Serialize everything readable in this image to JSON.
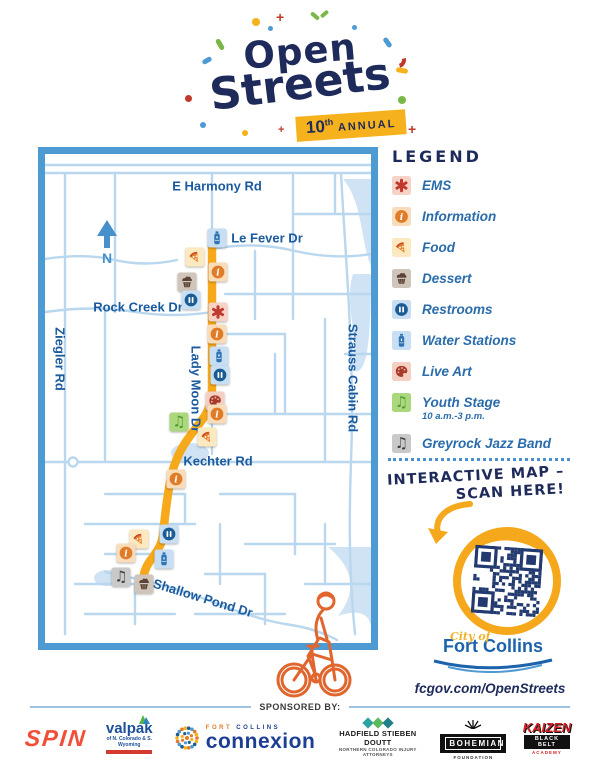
{
  "header": {
    "title_line1": "Open",
    "title_line2": "Streets",
    "badge": {
      "number": "10",
      "suffix": "th",
      "word": "ANNUAL"
    }
  },
  "map": {
    "north_label": "N",
    "street_labels": [
      {
        "text": "E Harmony Rd",
        "x": 172,
        "y": 32,
        "style": "h"
      },
      {
        "text": "Le Fever Dr",
        "x": 222,
        "y": 84,
        "style": "h"
      },
      {
        "text": "Rock Creek Dr",
        "x": 93,
        "y": 153,
        "style": "h"
      },
      {
        "text": "Ziegler Rd",
        "x": 15,
        "y": 205,
        "style": "v"
      },
      {
        "text": "Lady Moon Dr",
        "x": 151,
        "y": 235,
        "style": "v"
      },
      {
        "text": "Strauss Cabin Rd",
        "x": 308,
        "y": 224,
        "style": "v"
      },
      {
        "text": "Kechter Rd",
        "x": 173,
        "y": 307,
        "style": "h"
      },
      {
        "text": "Shallow Pond Dr",
        "x": 158,
        "y": 444,
        "style": "tilt"
      }
    ],
    "markers": [
      {
        "type": "water",
        "x": 172,
        "y": 84
      },
      {
        "type": "food",
        "x": 150,
        "y": 103
      },
      {
        "type": "info",
        "x": 173,
        "y": 118
      },
      {
        "type": "dessert",
        "x": 142,
        "y": 128
      },
      {
        "type": "restrooms",
        "x": 146,
        "y": 146
      },
      {
        "type": "ems",
        "x": 173,
        "y": 158
      },
      {
        "type": "info",
        "x": 172,
        "y": 180
      },
      {
        "type": "water",
        "x": 174,
        "y": 202
      },
      {
        "type": "restrooms",
        "x": 175,
        "y": 221
      },
      {
        "type": "liveart",
        "x": 170,
        "y": 247
      },
      {
        "type": "info",
        "x": 172,
        "y": 260
      },
      {
        "type": "youth",
        "x": 134,
        "y": 268
      },
      {
        "type": "food",
        "x": 162,
        "y": 283
      },
      {
        "type": "info",
        "x": 131,
        "y": 325
      },
      {
        "type": "restrooms",
        "x": 124,
        "y": 380
      },
      {
        "type": "food",
        "x": 94,
        "y": 385
      },
      {
        "type": "info",
        "x": 81,
        "y": 399
      },
      {
        "type": "water",
        "x": 119,
        "y": 405
      },
      {
        "type": "jazz",
        "x": 76,
        "y": 423
      },
      {
        "type": "dessert",
        "x": 99,
        "y": 430
      }
    ]
  },
  "legend": {
    "title": "LEGEND",
    "items": [
      {
        "type": "ems",
        "icon": "ems-icon",
        "label": "EMS"
      },
      {
        "type": "info",
        "icon": "information-icon",
        "label": "Information"
      },
      {
        "type": "food",
        "icon": "food-icon",
        "label": "Food"
      },
      {
        "type": "dessert",
        "icon": "dessert-icon",
        "label": "Dessert"
      },
      {
        "type": "restrooms",
        "icon": "restrooms-icon",
        "label": "Restrooms"
      },
      {
        "type": "water",
        "icon": "water-station-icon",
        "label": "Water Stations"
      },
      {
        "type": "liveart",
        "icon": "live-art-icon",
        "label": "Live Art"
      },
      {
        "type": "youth",
        "icon": "youth-stage-icon",
        "label": "Youth Stage",
        "sub": "10 a.m.-3 p.m."
      },
      {
        "type": "jazz",
        "icon": "jazz-band-icon",
        "label": "Greyrock Jazz Band"
      }
    ]
  },
  "cta": {
    "line1": "INTERACTIVE MAP –",
    "line2": "SCAN HERE!"
  },
  "footer": {
    "city_of": "City of",
    "city_name": "Fort Collins",
    "url": "fcgov.com/OpenStreets",
    "sponsored_by": "SPONSORED BY:",
    "sponsors": [
      {
        "id": "spin",
        "display": "SPIN"
      },
      {
        "id": "valpak",
        "display": "valpak",
        "sub": "of N. Colorado & S. Wyoming"
      },
      {
        "id": "connexion",
        "top1": "FORT",
        "top2": "COLLINS",
        "display": "connexion"
      },
      {
        "id": "hadfield",
        "display": "HADFIELD STIEBEN DOUTT",
        "sub": "NORTHERN COLORADO INJURY ATTORNEYS"
      },
      {
        "id": "bohemian",
        "display": "BOHEMIAN",
        "sub": "FOUNDATION"
      },
      {
        "id": "kaizen",
        "display": "KAIZEN",
        "sub": "BLACK BELT",
        "sub2": "ACADEMY"
      }
    ]
  },
  "colors": {
    "navy": "#1e2a5a",
    "map_border_blue": "#4e9ad3",
    "street_blue": "#b9d7ee",
    "route_yellow": "#f7a91c",
    "orange": "#e07b28",
    "red": "#c0392b",
    "green": "#7ab648",
    "label_blue": "#1a5a9e",
    "legend_blue": "#2a6cab"
  }
}
